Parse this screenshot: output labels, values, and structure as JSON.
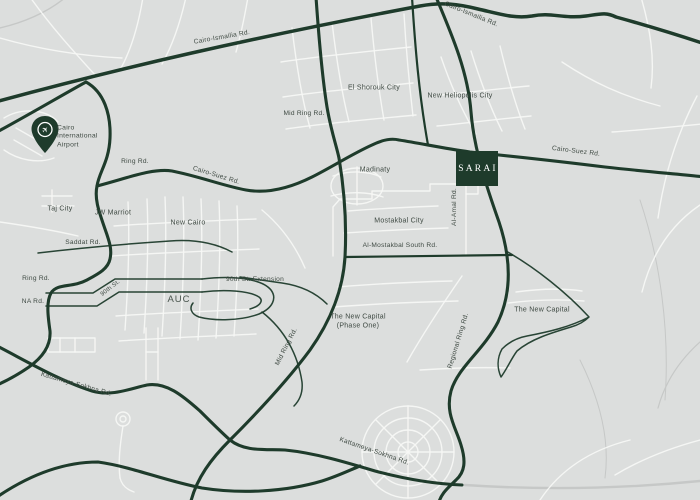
{
  "title": "SARAI location map - Greater Cairo road network",
  "colors": {
    "background": "#dcdedd",
    "road-dark": "#1e3b2b",
    "road-white": "#f6f7f5",
    "road-gray": "#c6c8c7",
    "label-text": "#3f4a43",
    "sarai-bg": "#1e3b2b",
    "sarai-text": "#ffffff",
    "pin": "#1e3b2b"
  },
  "marker": {
    "sarai_label": "SARAI"
  },
  "landmarks": {
    "airport": "Cairo International Airport",
    "airport_icon": "airplane-pin-icon"
  },
  "roads": {
    "cairo_ismailia_rd_1": "Cairo-Ismailia Rd.",
    "cairo_ismailia_rd_2": "Cairo-Ismailia Rd.",
    "mid_ring_rd_1": "Mid Ring Rd.",
    "ring_rd_1": "Ring Rd.",
    "cairo_suez_rd_1": "Cairo-Suez Rd.",
    "cairo_suez_rd_2": "Cairo-Suez Rd.",
    "al_amal_rd": "Al-Amal Rd.",
    "saddat_rd": "Saddat Rd.",
    "al_mostakbal_south_rd": "Al-Mostakbal South Rd.",
    "ring_rd_2": "Ring Rd.",
    "na_rd": "NA Rd.",
    "ninetieth_st": "90th St.",
    "ninetieth_st_extension": "90th St. Extension",
    "mid_ring_rd_2": "Mid Ring Rd.",
    "kattameya_sokhna_rd_1": "Kattameya-Sokhna Rd.",
    "regional_ring_rd": "Regional Ring Rd.",
    "kattameya_sokhna_rd_2": "Kattameya-Sokhna Rd."
  },
  "places": {
    "el_shorouk_city": "El Shorouk City",
    "new_heliopolis_city": "New Heliopolis City",
    "madinaty": "Madinaty",
    "taj_city": "Taj City",
    "jw_marriot": "JW Marriot",
    "new_cairo": "New Cairo",
    "mostakbal_city": "Mostakbal City",
    "auc": "AUC",
    "new_capital_phase_one_l1": "The New Capital",
    "new_capital_phase_one_l2": "(Phase One)",
    "the_new_capital": "The New Capital"
  }
}
